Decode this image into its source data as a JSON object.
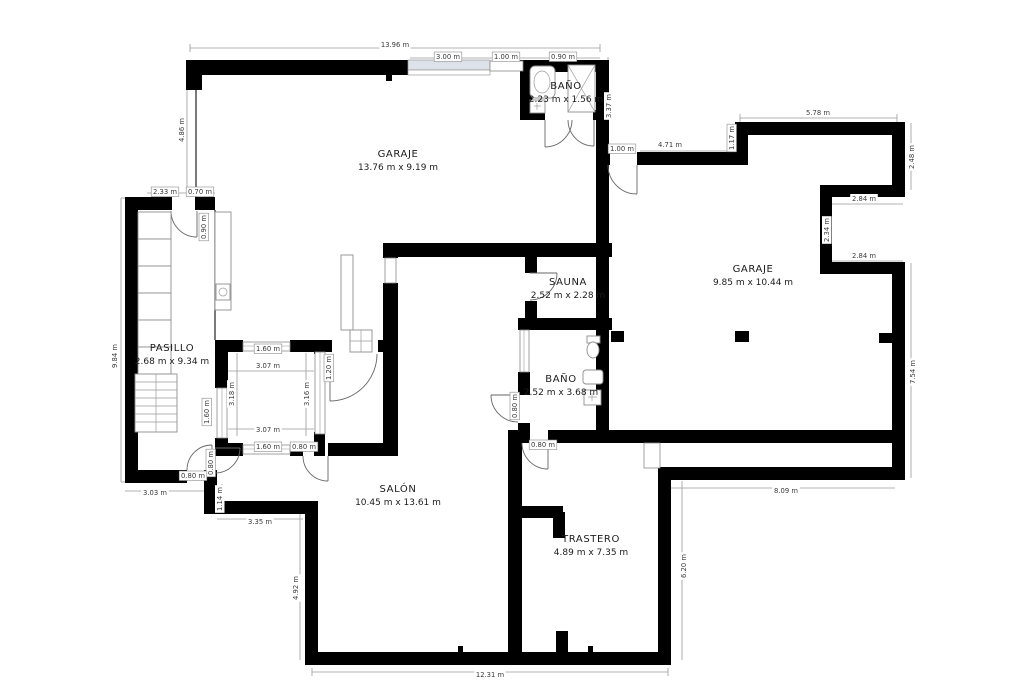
{
  "plan": {
    "background": "#ffffff",
    "wall_color": "#000000",
    "dimension_color": "#9a9a9a",
    "window_fill": "#dde1e9"
  },
  "rooms": [
    {
      "name": "GARAJE",
      "dims": "13.76 m x 9.19 m",
      "x": 398,
      "y": 157
    },
    {
      "name": "BAÑO",
      "dims": "2.23 m x 1.56 m",
      "x": 566,
      "y": 89
    },
    {
      "name": "GARAJE",
      "dims": "9.85 m x 10.44 m",
      "x": 753,
      "y": 272
    },
    {
      "name": "SAUNA",
      "dims": "2.52 m x 2.28 m",
      "x": 568,
      "y": 285
    },
    {
      "name": "PASILLO",
      "dims": "2.68 m x 9.34 m",
      "x": 172,
      "y": 351
    },
    {
      "name": "BAÑO",
      "dims": "2.52 m x 3.68 m",
      "x": 561,
      "y": 382
    },
    {
      "name": "SALÓN",
      "dims": "10.45 m x 13.61 m",
      "x": 398,
      "y": 492
    },
    {
      "name": "TRASTERO",
      "dims": "4.89 m x 7.35 m",
      "x": 591,
      "y": 542
    }
  ],
  "dimensions": [
    {
      "t": "13.96 m",
      "x": 395,
      "y": 47,
      "r": 0,
      "b": 0
    },
    {
      "t": "3.00 m",
      "x": 448,
      "y": 59,
      "r": 0,
      "b": 1
    },
    {
      "t": "1.00 m",
      "x": 506,
      "y": 59,
      "r": 0,
      "b": 1
    },
    {
      "t": "0.90 m",
      "x": 563,
      "y": 59,
      "r": 0,
      "b": 1
    },
    {
      "t": "4.86 m",
      "x": 184,
      "y": 130,
      "r": 1,
      "b": 0
    },
    {
      "t": "3.37 m",
      "x": 611,
      "y": 106,
      "r": 1,
      "b": 0
    },
    {
      "t": "1.00 m",
      "x": 622,
      "y": 151,
      "r": 0,
      "b": 1
    },
    {
      "t": "4.71 m",
      "x": 670,
      "y": 147,
      "r": 0,
      "b": 0
    },
    {
      "t": "1.17 m",
      "x": 734,
      "y": 138,
      "r": 1,
      "b": 1
    },
    {
      "t": "5.78 m",
      "x": 818,
      "y": 115,
      "r": 0,
      "b": 0
    },
    {
      "t": "2.48 m",
      "x": 914,
      "y": 157,
      "r": 1,
      "b": 0
    },
    {
      "t": "2.84 m",
      "x": 864,
      "y": 201,
      "r": 0,
      "b": 0
    },
    {
      "t": "2.34 m",
      "x": 829,
      "y": 230,
      "r": 1,
      "b": 0
    },
    {
      "t": "2.84 m",
      "x": 864,
      "y": 258,
      "r": 0,
      "b": 0
    },
    {
      "t": "7.54 m",
      "x": 915,
      "y": 372,
      "r": 1,
      "b": 0
    },
    {
      "t": "8.09 m",
      "x": 786,
      "y": 493,
      "r": 0,
      "b": 0
    },
    {
      "t": "6.20 m",
      "x": 686,
      "y": 566,
      "r": 1,
      "b": 0
    },
    {
      "t": "12.31 m",
      "x": 490,
      "y": 677,
      "r": 0,
      "b": 0
    },
    {
      "t": "4.92 m",
      "x": 298,
      "y": 588,
      "r": 1,
      "b": 0
    },
    {
      "t": "3.35 m",
      "x": 260,
      "y": 524,
      "r": 0,
      "b": 0
    },
    {
      "t": "1.14 m",
      "x": 222,
      "y": 499,
      "r": 1,
      "b": 0
    },
    {
      "t": "3.03 m",
      "x": 155,
      "y": 495,
      "r": 0,
      "b": 0
    },
    {
      "t": "9.84 m",
      "x": 117,
      "y": 356,
      "r": 1,
      "b": 0
    },
    {
      "t": "2.33 m",
      "x": 165,
      "y": 194,
      "r": 0,
      "b": 1
    },
    {
      "t": "0.70 m",
      "x": 200,
      "y": 194,
      "r": 0,
      "b": 1
    },
    {
      "t": "0.90 m",
      "x": 206,
      "y": 227,
      "r": 1,
      "b": 1
    },
    {
      "t": "1.60 m",
      "x": 268,
      "y": 351,
      "r": 0,
      "b": 1
    },
    {
      "t": "3.07 m",
      "x": 268,
      "y": 368,
      "r": 0,
      "b": 0
    },
    {
      "t": "3.18 m",
      "x": 234,
      "y": 394,
      "r": 1,
      "b": 0
    },
    {
      "t": "3.16 m",
      "x": 309,
      "y": 394,
      "r": 1,
      "b": 0
    },
    {
      "t": "1.60 m",
      "x": 209,
      "y": 412,
      "r": 1,
      "b": 1
    },
    {
      "t": "1.20 m",
      "x": 331,
      "y": 368,
      "r": 1,
      "b": 1
    },
    {
      "t": "3.07 m",
      "x": 268,
      "y": 432,
      "r": 0,
      "b": 0
    },
    {
      "t": "1.60 m",
      "x": 268,
      "y": 449,
      "r": 0,
      "b": 1
    },
    {
      "t": "0.80 m",
      "x": 304,
      "y": 449,
      "r": 0,
      "b": 1
    },
    {
      "t": "0.80 m",
      "x": 213,
      "y": 463,
      "r": 1,
      "b": 1
    },
    {
      "t": "0.80 m",
      "x": 193,
      "y": 478,
      "r": 0,
      "b": 1
    },
    {
      "t": "0.80 m",
      "x": 517,
      "y": 406,
      "r": 1,
      "b": 1
    },
    {
      "t": "0.80 m",
      "x": 543,
      "y": 447,
      "r": 0,
      "b": 1
    }
  ]
}
